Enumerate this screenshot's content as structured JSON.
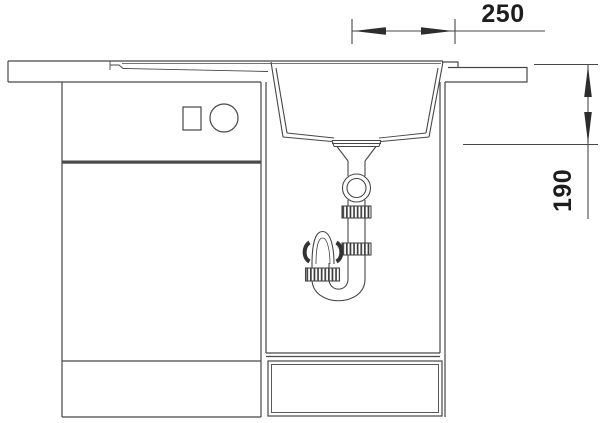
{
  "colors": {
    "line": "#474747",
    "line_dark": "#2d2d2d",
    "background": "#ffffff",
    "text": "#1d1d1d"
  },
  "dimensions": {
    "horizontal": {
      "label": "250"
    },
    "vertical": {
      "label": "190"
    }
  }
}
